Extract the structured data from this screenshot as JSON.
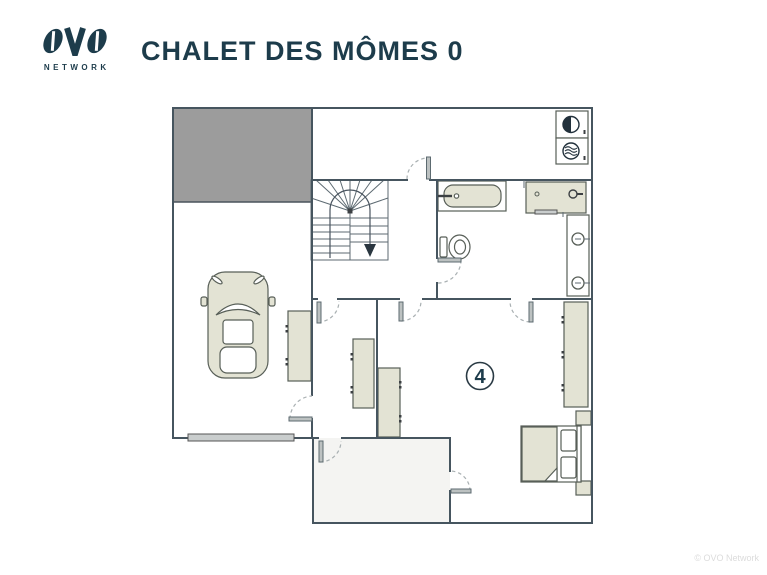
{
  "header": {
    "title": "CHALET DES MÔMES 0"
  },
  "brand": {
    "name": "OVO",
    "subtitle": "NETWORK"
  },
  "plan": {
    "room_number": "4",
    "fixtures": [
      "garage-void",
      "staircase-down",
      "car",
      "bathtub",
      "shower",
      "toilet",
      "towel-radiator",
      "washing-machine",
      "tumble-dryer",
      "wardrobes",
      "double-bed",
      "nightstands",
      "garage-door"
    ]
  },
  "footer": {
    "copyright": "© OVO Network"
  },
  "colors": {
    "navy": "#1d3c4b",
    "wall": "#46555f",
    "fixture": "#e3e3d4",
    "void": "#9c9c9c",
    "door": "#bcc1c1",
    "dash": "#a9b0b2",
    "room": "#f4f4f2",
    "muted": "#dcdcdc"
  }
}
